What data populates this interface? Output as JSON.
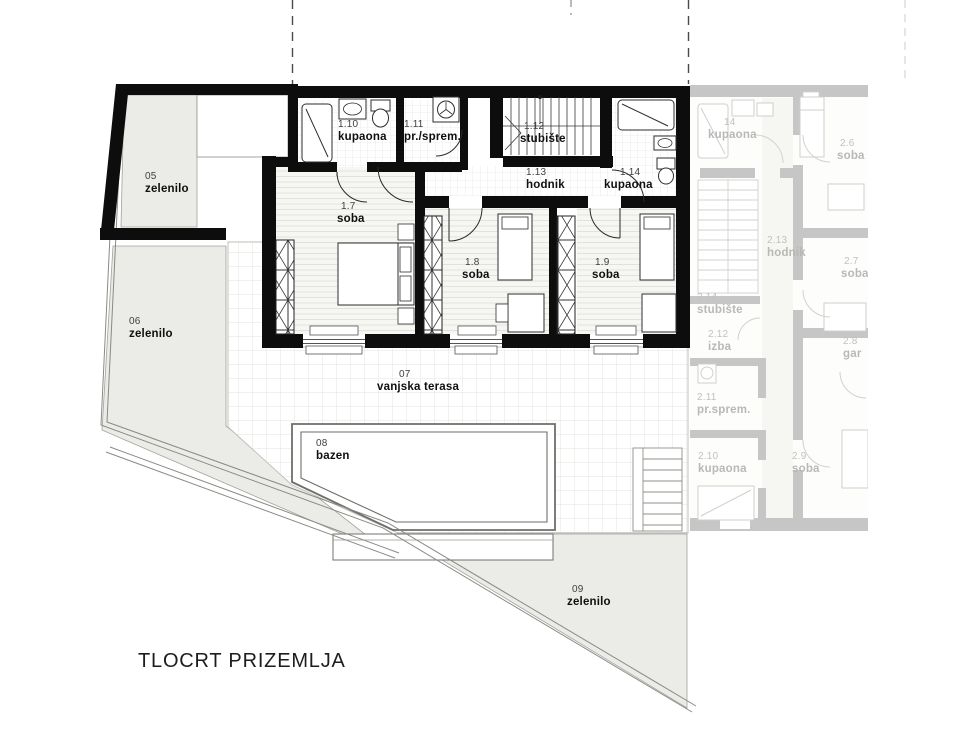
{
  "title": "TLOCRT PRIZEMLJA",
  "unit1": {
    "z05": {
      "num": "05",
      "name": "zelenilo"
    },
    "z06": {
      "num": "06",
      "name": "zelenilo"
    },
    "k110": {
      "num": "1.10",
      "name": "kupaona"
    },
    "s111": {
      "num": "1.11",
      "name": "pr./sprem."
    },
    "st112": {
      "num": "1.12",
      "name": "stubište"
    },
    "h113": {
      "num": "1.13",
      "name": "hodnik"
    },
    "k114": {
      "num": "1.14",
      "name": "kupaona"
    },
    "r17": {
      "num": "1.7",
      "name": "soba"
    },
    "r18": {
      "num": "1.8",
      "name": "soba"
    },
    "r19": {
      "num": "1.9",
      "name": "soba"
    },
    "t07": {
      "num": "07",
      "name": "vanjska terasa"
    },
    "b08": {
      "num": "08",
      "name": "bazen"
    },
    "z09": {
      "num": "09",
      "name": "zelenilo"
    }
  },
  "unit2": {
    "k14": {
      "num": "14",
      "name": "kupaona"
    },
    "r26": {
      "num": "2.6",
      "name": "soba"
    },
    "h213": {
      "num": "2.13",
      "name": "hodnik"
    },
    "st214": {
      "num": "2.14",
      "name": "stubište"
    },
    "i212": {
      "num": "2.12",
      "name": "izba"
    },
    "s211": {
      "num": "2.11",
      "name": "pr.sprem."
    },
    "r27": {
      "num": "2.7",
      "name": "soba"
    },
    "g28": {
      "num": "2.8",
      "name": "gar"
    },
    "k210": {
      "num": "2.10",
      "name": "kupaona"
    },
    "r29": {
      "num": "2.9",
      "name": "soba"
    }
  },
  "colors": {
    "wall": "#0d0d0d",
    "faded_wall": "#c6c6c6",
    "green_fill": "#ebebe7",
    "grid_line": "#e2e2df"
  }
}
